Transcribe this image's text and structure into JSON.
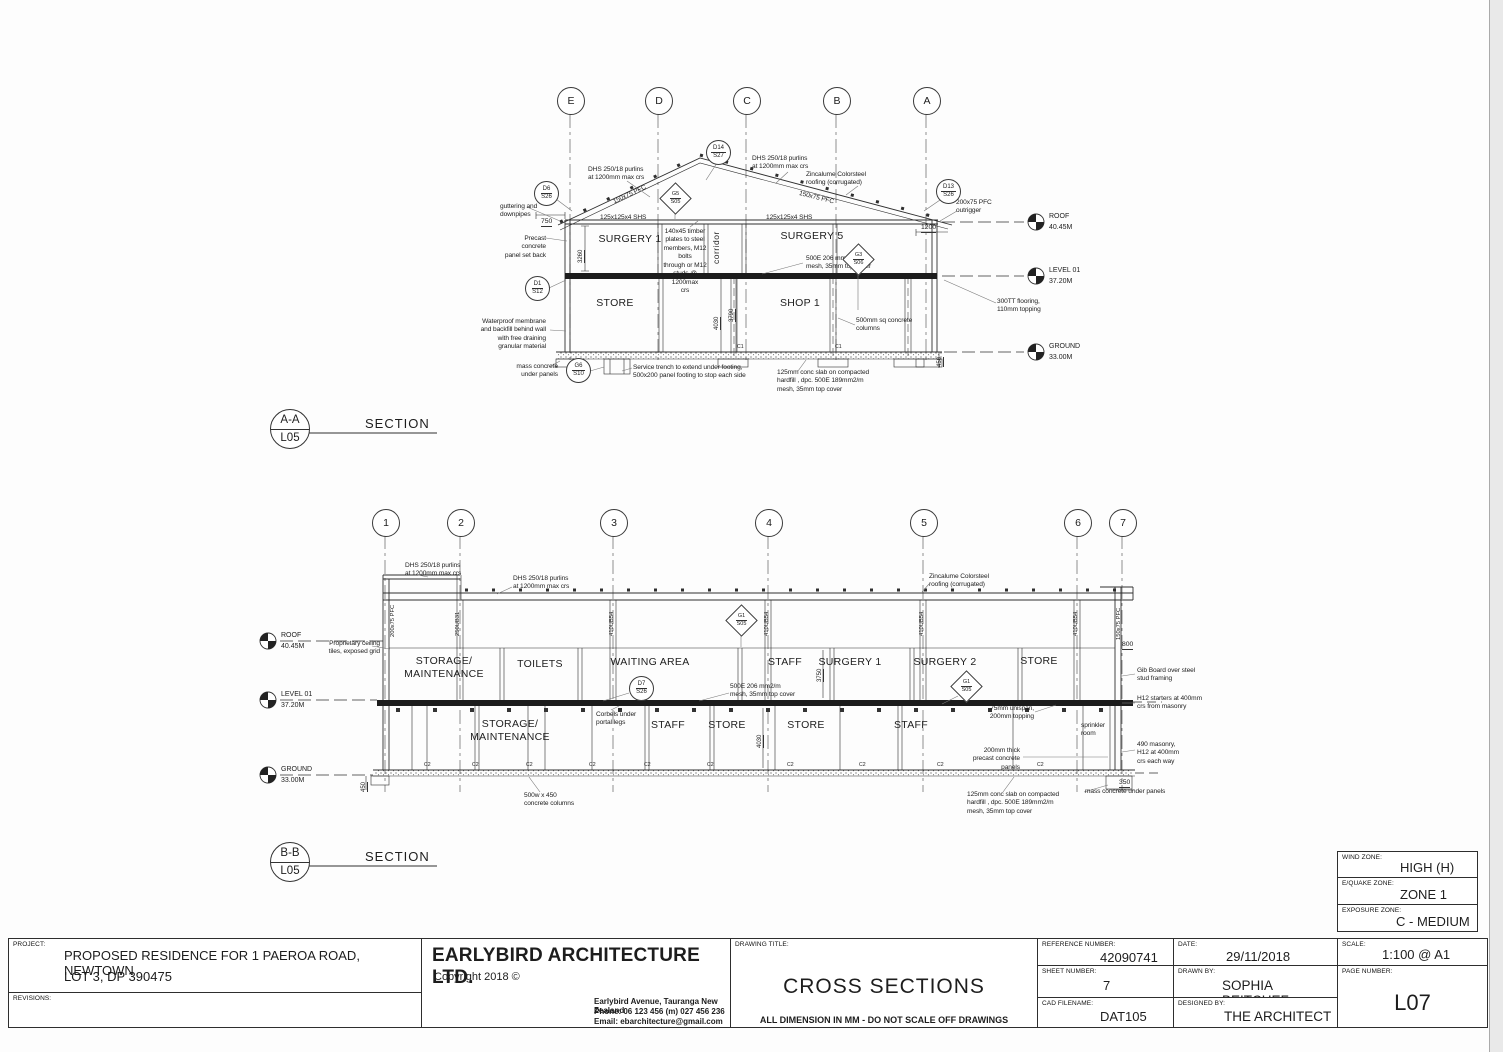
{
  "sheet": {
    "zonebox": {
      "wind_label": "WIND ZONE:",
      "wind": "HIGH (H)",
      "equake_label": "E/QUAKE ZONE:",
      "equake": "ZONE 1",
      "exposure_label": "EXPOSURE ZONE:",
      "exposure": "C - MEDIUM"
    },
    "titleblock": {
      "project_label": "PROJECT:",
      "project_line1": "PROPOSED RESIDENCE FOR 1 PAEROA ROAD, NEWTOWN",
      "project_line2": "LOT 3, DP 390475",
      "revisions_label": "REVISIONS:",
      "firm_name": "EARLYBIRD ARCHITECTURE LTD.",
      "copyright": "Copyright 2018 ©",
      "address_line1": "Earlybird Avenue, Tauranga New Zealand",
      "address_line2": "Phone: 06 123 456 (m) 027 456 236",
      "address_line3": "Email:  ebarchitecture@gmail.com",
      "drawing_title_label": "DRAWING TITLE:",
      "drawing_title": "CROSS SECTIONS",
      "disclaimer": "ALL DIMENSION IN MM - DO NOT SCALE OFF DRAWINGS",
      "reference_label": "REFERENCE NUMBER:",
      "reference_number": "42090741",
      "sheet_label": "SHEET NUMBER:",
      "sheet_number": "7",
      "cad_label": "CAD FILENAME:",
      "cad_filename": "DAT105",
      "date_label": "DATE:",
      "date": "29/11/2018",
      "drawn_label": "DRAWN BY:",
      "drawn_by": "SOPHIA BEITCHEF",
      "designed_label": "DESIGNED BY:",
      "designed_by": "THE ARCHITECT",
      "scale_label": "SCALE:",
      "scale": "1:100 @ A1",
      "page_label": "PAGE NUMBER:",
      "page_number": "L07"
    }
  },
  "sectionA": {
    "name": "A-A",
    "sheet": "L05",
    "caption": "SECTION",
    "grids": [
      {
        "label": "E",
        "x": 570,
        "y": 100
      },
      {
        "label": "D",
        "x": 658,
        "y": 100
      },
      {
        "label": "C",
        "x": 746,
        "y": 100
      },
      {
        "label": "B",
        "x": 836,
        "y": 100
      },
      {
        "label": "A",
        "x": 926,
        "y": 100
      }
    ],
    "levels": [
      {
        "name": "ROOF",
        "elev": "40.45M",
        "x": 1036,
        "y": 222
      },
      {
        "name": "LEVEL 01",
        "elev": "37.20M",
        "x": 1036,
        "y": 276
      },
      {
        "name": "GROUND",
        "elev": "33.00M",
        "x": 1036,
        "y": 352
      }
    ],
    "bubbles": [
      {
        "shape": "circle",
        "top": "D6",
        "bot": "S26",
        "x": 546,
        "y": 193
      },
      {
        "shape": "circle",
        "top": "D14",
        "bot": "S27",
        "x": 718,
        "y": 152
      },
      {
        "shape": "circle",
        "top": "D13",
        "bot": "S26",
        "x": 948,
        "y": 191
      },
      {
        "shape": "circle",
        "top": "D1",
        "bot": "S12",
        "x": 537,
        "y": 288
      },
      {
        "shape": "circle",
        "top": "G6",
        "bot": "S10",
        "x": 578,
        "y": 370
      },
      {
        "shape": "diamond",
        "top": "G5",
        "bot": "S05",
        "x": 675,
        "y": 198
      },
      {
        "shape": "diamond",
        "top": "G3",
        "bot": "S06",
        "x": 858,
        "y": 259
      }
    ],
    "labels": [
      {
        "t": "DHS 250/18 purlins\nat 1200mm max crs",
        "x": 588,
        "y": 166,
        "cls": "note"
      },
      {
        "t": "DHS 250/18 purlins\nat 1200mm max crs",
        "x": 752,
        "y": 155,
        "cls": "note"
      },
      {
        "t": "Zincalume Colorsteel\nroofing (corrugated)",
        "x": 806,
        "y": 171,
        "cls": "note"
      },
      {
        "t": "guttering and\ndownpipes",
        "x": 500,
        "y": 203,
        "cls": "note"
      },
      {
        "t": "Precast concrete\npanel set back",
        "x": 500,
        "y": 235,
        "cls": "note",
        "align": "right",
        "w": 46
      },
      {
        "t": "125x125x4 SHS",
        "x": 600,
        "y": 214,
        "cls": "note"
      },
      {
        "t": "125x125x4 SHS",
        "x": 766,
        "y": 214,
        "cls": "note"
      },
      {
        "t": "200x75 PFC\noutrigger",
        "x": 956,
        "y": 199,
        "cls": "note"
      },
      {
        "t": "140x45 timber\nplates to steel\nmembers, M12 bolts\nthrough or M12\nstuds @ 1200max\ncrs",
        "x": 662,
        "y": 228,
        "cls": "note",
        "align": "center",
        "w": 46
      },
      {
        "t": "500E 206 mm2/m\nmesh, 35mm top cover",
        "x": 806,
        "y": 255,
        "cls": "note"
      },
      {
        "t": "300TT flooring,\n110mm topping",
        "x": 997,
        "y": 298,
        "cls": "note"
      },
      {
        "t": "500mm sq concrete\ncolumns",
        "x": 856,
        "y": 317,
        "cls": "note"
      },
      {
        "t": "Waterproof membrane\nand backfill behind wall\nwith free draining\ngranular material",
        "x": 474,
        "y": 318,
        "cls": "note",
        "align": "right",
        "w": 72
      },
      {
        "t": "mass concrete\nunder panels",
        "x": 510,
        "y": 363,
        "cls": "note",
        "align": "right",
        "w": 48
      },
      {
        "t": "Service trench to extend under footing,\n500x200 panel footing to stop each side",
        "x": 633,
        "y": 364,
        "cls": "note"
      },
      {
        "t": "125mm conc slab on compacted\nhardfill , dpc. 500E 189mm2/m\nmesh, 35mm top cover",
        "x": 777,
        "y": 369,
        "cls": "note"
      },
      {
        "t": "150x75 PFC",
        "x": 612,
        "y": 199,
        "cls": "note",
        "rot": -25
      },
      {
        "t": "150x75 PFC",
        "x": 800,
        "y": 190,
        "cls": "note",
        "rot": 14
      },
      {
        "t": "SURGERY 1",
        "x": 580,
        "y": 233,
        "cls": "room",
        "align": "center",
        "w": 100
      },
      {
        "t": "corridor",
        "x": 711,
        "y": 264,
        "cls": "room-sm",
        "rot": -90
      },
      {
        "t": "SURGERY 5",
        "x": 762,
        "y": 230,
        "cls": "room",
        "align": "center",
        "w": 100
      },
      {
        "t": "STORE",
        "x": 565,
        "y": 297,
        "cls": "room",
        "align": "center",
        "w": 100
      },
      {
        "t": "SHOP 1",
        "x": 750,
        "y": 297,
        "cls": "room",
        "align": "center",
        "w": 100
      },
      {
        "t": "750",
        "x": 541,
        "y": 218,
        "cls": "dim"
      },
      {
        "t": "1200",
        "x": 921,
        "y": 224,
        "cls": "dim"
      },
      {
        "t": "3260",
        "x": 578,
        "y": 263,
        "cls": "dim-sm",
        "rot": -90
      },
      {
        "t": "4030",
        "x": 714,
        "y": 330,
        "cls": "dim-sm",
        "rot": -90
      },
      {
        "t": "3790",
        "x": 729,
        "y": 322,
        "cls": "dim-sm",
        "rot": -90
      },
      {
        "t": "450",
        "x": 937,
        "y": 367,
        "cls": "dim-sm",
        "rot": -90
      },
      {
        "t": "C1",
        "x": 737,
        "y": 344,
        "cls": "tiny"
      },
      {
        "t": "C1",
        "x": 835,
        "y": 344,
        "cls": "tiny"
      }
    ]
  },
  "sectionB": {
    "name": "B-B",
    "sheet": "L05",
    "caption": "SECTION",
    "grids": [
      {
        "label": "1",
        "x": 385,
        "y": 522
      },
      {
        "label": "2",
        "x": 460,
        "y": 522
      },
      {
        "label": "3",
        "x": 613,
        "y": 522
      },
      {
        "label": "4",
        "x": 768,
        "y": 522
      },
      {
        "label": "5",
        "x": 923,
        "y": 522
      },
      {
        "label": "6",
        "x": 1077,
        "y": 522
      },
      {
        "label": "7",
        "x": 1122,
        "y": 522
      }
    ],
    "levels": [
      {
        "name": "ROOF",
        "elev": "40.45M",
        "x": 268,
        "y": 641
      },
      {
        "name": "LEVEL 01",
        "elev": "37.20M",
        "x": 268,
        "y": 700
      },
      {
        "name": "GROUND",
        "elev": "33.00M",
        "x": 268,
        "y": 775
      }
    ],
    "bubbles": [
      {
        "shape": "circle",
        "top": "D7",
        "bot": "S26",
        "x": 641,
        "y": 688
      },
      {
        "shape": "diamond",
        "top": "G1",
        "bot": "S05",
        "x": 741,
        "y": 620
      },
      {
        "shape": "diamond",
        "top": "G1",
        "bot": "S05",
        "x": 966,
        "y": 686
      }
    ],
    "labels": [
      {
        "t": "DHS 250/18 purlins\nat 1200mm max crs",
        "x": 405,
        "y": 562,
        "cls": "note"
      },
      {
        "t": "DHS 250/18 purlins\nat 1200mm max crs",
        "x": 513,
        "y": 575,
        "cls": "note"
      },
      {
        "t": "Zincalume Colorsteel\nroofing (corrugated)",
        "x": 929,
        "y": 573,
        "cls": "note"
      },
      {
        "t": "Proprietary ceiling\ntiles, exposed grid",
        "x": 322,
        "y": 640,
        "cls": "note",
        "align": "right",
        "w": 58
      },
      {
        "t": "STORAGE/\nMAINTENANCE",
        "x": 394,
        "y": 655,
        "cls": "room",
        "align": "center",
        "w": 100
      },
      {
        "t": "TOILETS",
        "x": 490,
        "y": 658,
        "cls": "room",
        "align": "center",
        "w": 100
      },
      {
        "t": "WAITING AREA",
        "x": 600,
        "y": 656,
        "cls": "room",
        "align": "center",
        "w": 100
      },
      {
        "t": "STAFF",
        "x": 735,
        "y": 656,
        "cls": "room",
        "align": "center",
        "w": 100
      },
      {
        "t": "SURGERY 1",
        "x": 800,
        "y": 656,
        "cls": "room",
        "align": "center",
        "w": 100
      },
      {
        "t": "SURGERY 2",
        "x": 895,
        "y": 656,
        "cls": "room",
        "align": "center",
        "w": 100
      },
      {
        "t": "STORE",
        "x": 989,
        "y": 655,
        "cls": "room",
        "align": "center",
        "w": 100
      },
      {
        "t": "STORAGE/\nMAINTENANCE",
        "x": 460,
        "y": 718,
        "cls": "room",
        "align": "center",
        "w": 100
      },
      {
        "t": "STAFF",
        "x": 618,
        "y": 719,
        "cls": "room",
        "align": "center",
        "w": 100
      },
      {
        "t": "STORE",
        "x": 677,
        "y": 719,
        "cls": "room",
        "align": "center",
        "w": 100
      },
      {
        "t": "STORE",
        "x": 756,
        "y": 719,
        "cls": "room",
        "align": "center",
        "w": 100
      },
      {
        "t": "STAFF",
        "x": 861,
        "y": 719,
        "cls": "room",
        "align": "center",
        "w": 100
      },
      {
        "t": "sprinkler\nroom",
        "x": 1081,
        "y": 722,
        "cls": "note"
      },
      {
        "t": "Corbels under\nportal legs",
        "x": 596,
        "y": 711,
        "cls": "note"
      },
      {
        "t": "500E 206 mm2/m\nmesh, 35mm top cover",
        "x": 730,
        "y": 683,
        "cls": "note"
      },
      {
        "t": "75mm unispan,\n200mm topping",
        "x": 986,
        "y": 705,
        "cls": "note",
        "align": "right",
        "w": 48
      },
      {
        "t": "200mm thick\nprecast concrete\npanels",
        "x": 960,
        "y": 747,
        "cls": "note",
        "align": "right",
        "w": 60
      },
      {
        "t": "Gib Board over steel\nstud framing",
        "x": 1137,
        "y": 667,
        "cls": "note"
      },
      {
        "t": "H12 starters at 400mm\ncrs from masonry",
        "x": 1137,
        "y": 695,
        "cls": "note"
      },
      {
        "t": "490 masonry,\nH12 at 400mm\ncrs each way",
        "x": 1137,
        "y": 741,
        "cls": "note"
      },
      {
        "t": "mass concrete under panels",
        "x": 1085,
        "y": 788,
        "cls": "note"
      },
      {
        "t": "125mm conc slab on compacted\nhardfill , dpc. 500E 189mm2/m\nmesh, 35mm top cover",
        "x": 967,
        "y": 791,
        "cls": "note"
      },
      {
        "t": "500w x 450\nconcrete columns",
        "x": 524,
        "y": 792,
        "cls": "note"
      },
      {
        "t": "800",
        "x": 1122,
        "y": 641,
        "cls": "dim"
      },
      {
        "t": "350",
        "x": 1119,
        "y": 779,
        "cls": "dim"
      },
      {
        "t": "450",
        "x": 361,
        "y": 792,
        "cls": "dim-sm",
        "rot": -90
      },
      {
        "t": "4030",
        "x": 757,
        "y": 748,
        "cls": "dim-sm",
        "rot": -90
      },
      {
        "t": "3750",
        "x": 817,
        "y": 682,
        "cls": "dim-sm",
        "rot": -90
      },
      {
        "t": "200x75 PFC",
        "x": 390,
        "y": 637,
        "cls": "col",
        "rot": -90
      },
      {
        "t": "250UB31",
        "x": 455,
        "y": 636,
        "cls": "col",
        "rot": -90
      },
      {
        "t": "410UB54",
        "x": 609,
        "y": 636,
        "cls": "col",
        "rot": -90
      },
      {
        "t": "410UB54",
        "x": 764,
        "y": 636,
        "cls": "col",
        "rot": -90
      },
      {
        "t": "410UB54",
        "x": 919,
        "y": 636,
        "cls": "col",
        "rot": -90
      },
      {
        "t": "410UB54",
        "x": 1073,
        "y": 636,
        "cls": "col",
        "rot": -90
      },
      {
        "t": "150x75 PFC",
        "x": 1116,
        "y": 640,
        "cls": "col",
        "rot": -90
      },
      {
        "t": "C2",
        "x": 424,
        "y": 762,
        "cls": "tiny"
      },
      {
        "t": "C2",
        "x": 472,
        "y": 762,
        "cls": "tiny"
      },
      {
        "t": "C2",
        "x": 526,
        "y": 762,
        "cls": "tiny"
      },
      {
        "t": "C2",
        "x": 589,
        "y": 762,
        "cls": "tiny"
      },
      {
        "t": "C2",
        "x": 644,
        "y": 762,
        "cls": "tiny"
      },
      {
        "t": "C2",
        "x": 707,
        "y": 762,
        "cls": "tiny"
      },
      {
        "t": "C2",
        "x": 787,
        "y": 762,
        "cls": "tiny"
      },
      {
        "t": "C2",
        "x": 859,
        "y": 762,
        "cls": "tiny"
      },
      {
        "t": "C2",
        "x": 937,
        "y": 762,
        "cls": "tiny"
      },
      {
        "t": "C2",
        "x": 1037,
        "y": 762,
        "cls": "tiny"
      }
    ]
  }
}
